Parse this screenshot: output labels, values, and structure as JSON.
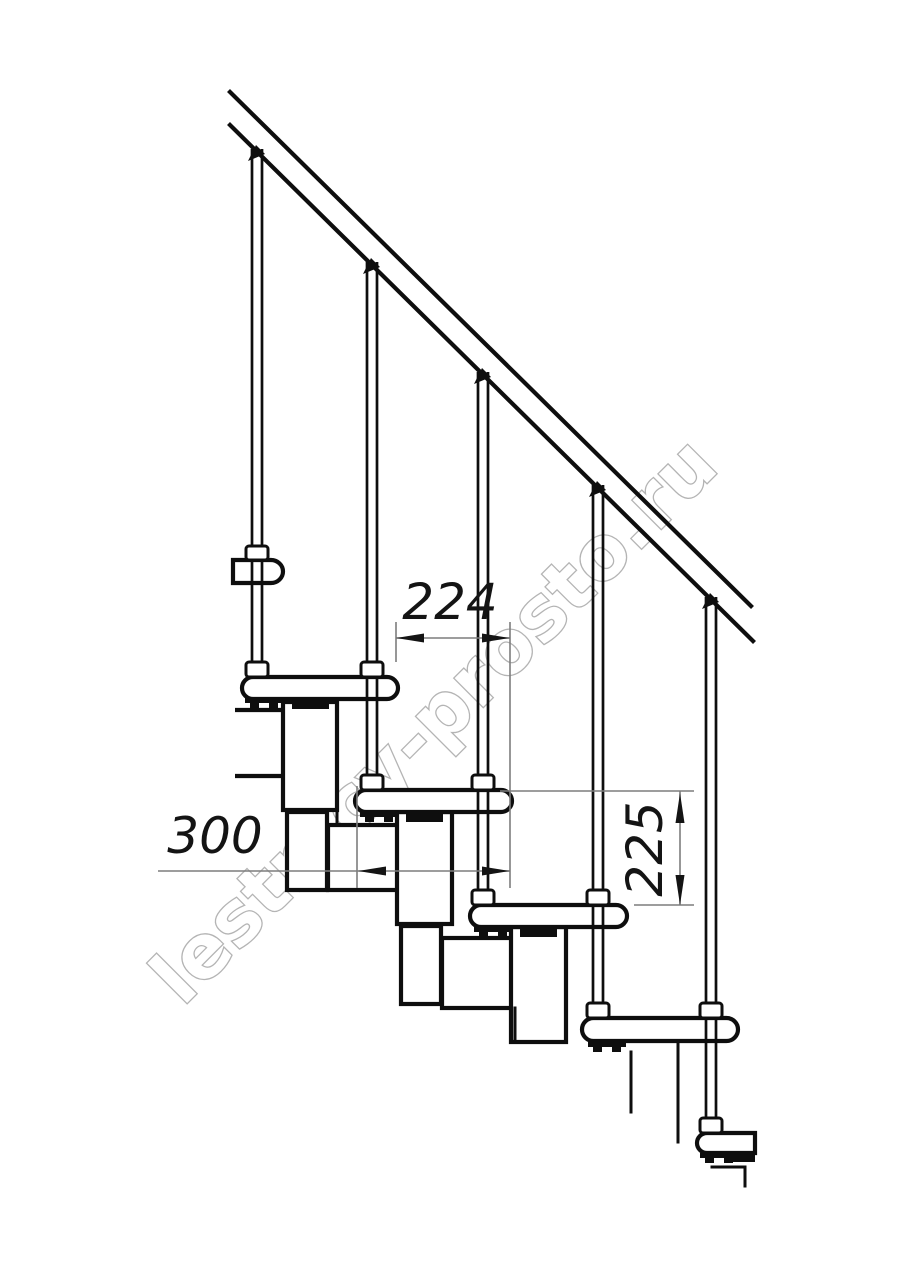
{
  "drawing": {
    "kind": "modular-staircase-side-view-technical-drawing",
    "watermark": "lestnicy-prosto.ru",
    "colors": {
      "background": "#ffffff",
      "line": "#0e0e0e",
      "dimension_line": "#7d7d7d",
      "dimension_text": "#141414",
      "watermark_outline": "#a8a8a8"
    },
    "dimensions": {
      "step_run": {
        "value": "224",
        "orientation": "horizontal"
      },
      "tread_depth": {
        "value": "300",
        "orientation": "horizontal"
      },
      "step_rise": {
        "value": "225",
        "orientation": "vertical"
      }
    },
    "components": {
      "handrail_count": 1,
      "baluster_count": 5,
      "tread_count": 6,
      "module_block_count": 7
    }
  }
}
